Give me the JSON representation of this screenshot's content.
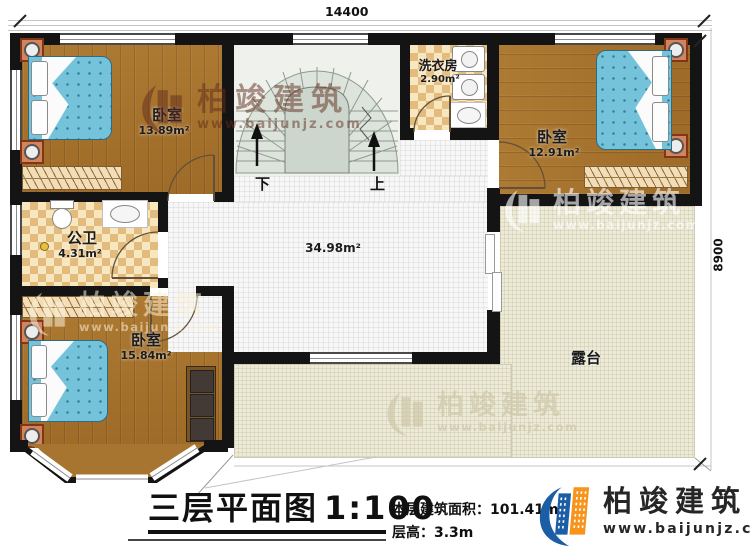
{
  "dimensions": {
    "top": "14400",
    "right": "8900"
  },
  "rooms": {
    "bedroom_top_left": {
      "name": "卧室",
      "area": "13.89m²"
    },
    "bathroom": {
      "name": "公卫",
      "area": "4.31m²"
    },
    "bedroom_bottom_left": {
      "name": "卧室",
      "area": "15.84m²"
    },
    "laundry": {
      "name": "洗衣房",
      "area": "2.90m²"
    },
    "bedroom_top_right": {
      "name": "卧室",
      "area": "12.91m²"
    },
    "hall": {
      "area": "34.98m²"
    },
    "terrace": {
      "name": "露台"
    }
  },
  "stairs": {
    "down_label": "下",
    "up_label": "上"
  },
  "title_block": {
    "title": "三层平面图",
    "scale": "1:100",
    "area_label": "本层建筑面积：",
    "area_value": "101.41m²",
    "height_label": "层高：",
    "height_value": "3.3m"
  },
  "logo": {
    "name": "柏竣建筑",
    "url": "www.baijunjz.com"
  },
  "watermark": {
    "name": "柏竣建筑",
    "url": "www.baijunjz.com"
  },
  "icons": {
    "logo": "building-swoosh-icon"
  },
  "colors": {
    "wall": "#141414",
    "wood": "#a9772f",
    "tile": "#f0d39a",
    "stair": "#dde4dc",
    "terrace": "#edead8",
    "bed": "#74c3da",
    "logo_blue": "#1b5ea6",
    "logo_orange": "#f7941d"
  }
}
